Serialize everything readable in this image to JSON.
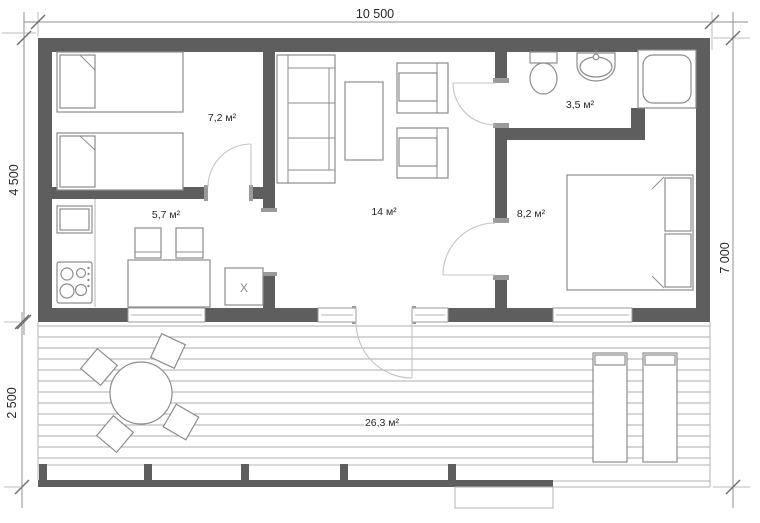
{
  "drawing": {
    "type": "floor-plan",
    "dimension_labels": {
      "top": "10 500",
      "left_upper": "4 500",
      "left_lower": "2 500",
      "right": "7 000"
    },
    "room_areas": {
      "bedroom_small": "7,2 м²",
      "kitchen": "5,7 м²",
      "living_room": "14 м²",
      "bathroom": "3,5 м²",
      "bedroom_master": "8,2 м²",
      "terrace": "26,3 м²"
    },
    "fixture_labels": {
      "appliance_box": "X"
    },
    "colors": {
      "wall": "#5e5e5e",
      "furniture_line": "#8c8c8c",
      "light_line": "#b3b3b3",
      "dimension_line": "#8f8f8f",
      "text": "#262626"
    }
  }
}
